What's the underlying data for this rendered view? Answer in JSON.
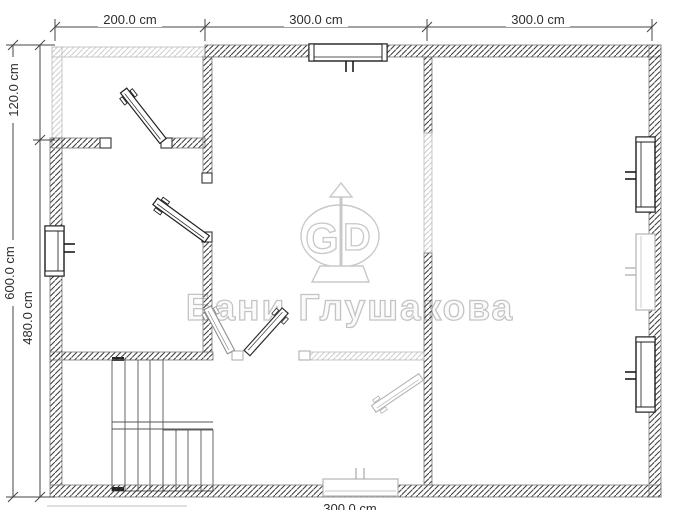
{
  "document": {
    "type": "floor-plan",
    "units": "cm"
  },
  "dimensions": {
    "top": [
      {
        "label": "200.0 cm"
      },
      {
        "label": "300.0 cm"
      },
      {
        "label": "300.0 cm"
      }
    ],
    "left": [
      {
        "label": "120.0 cm"
      },
      {
        "label": "600.0 cm"
      },
      {
        "label": "480.0 cm"
      }
    ],
    "bottom": [
      {
        "label": "300.0 cm"
      }
    ]
  },
  "watermark": {
    "brand": "Бани Глушакова",
    "logo": {
      "left_letter": "G",
      "right_letter": "D"
    }
  },
  "plan_features": {
    "rooms": [
      "terrace-top-left",
      "room-left",
      "room-center",
      "room-bottom-center-with-stairs",
      "room-right"
    ],
    "windows": [
      "top-wall-window",
      "left-wall-window",
      "right-wall-window-upper",
      "right-wall-window-middle-light",
      "right-wall-window-lower",
      "bottom-wall-window-light"
    ],
    "doors": [
      "terrace-door",
      "left-room-door",
      "center-room-double-door",
      "bottom-room-light-door"
    ],
    "stairs": "l-shaped-staircase-bottom-left"
  },
  "colors": {
    "wall_hatch_dark": "#3a3a3a",
    "wall_hatch_light": "#cccccc",
    "wall_outline": "#777777",
    "dimension_lines": "#444444",
    "dimension_text": "#2e2e2e",
    "watermark_gray": "#c4c4c4",
    "window_dark": "#1c1c1c",
    "symbol_light": "#b5b5b5",
    "background": "#ffffff"
  }
}
